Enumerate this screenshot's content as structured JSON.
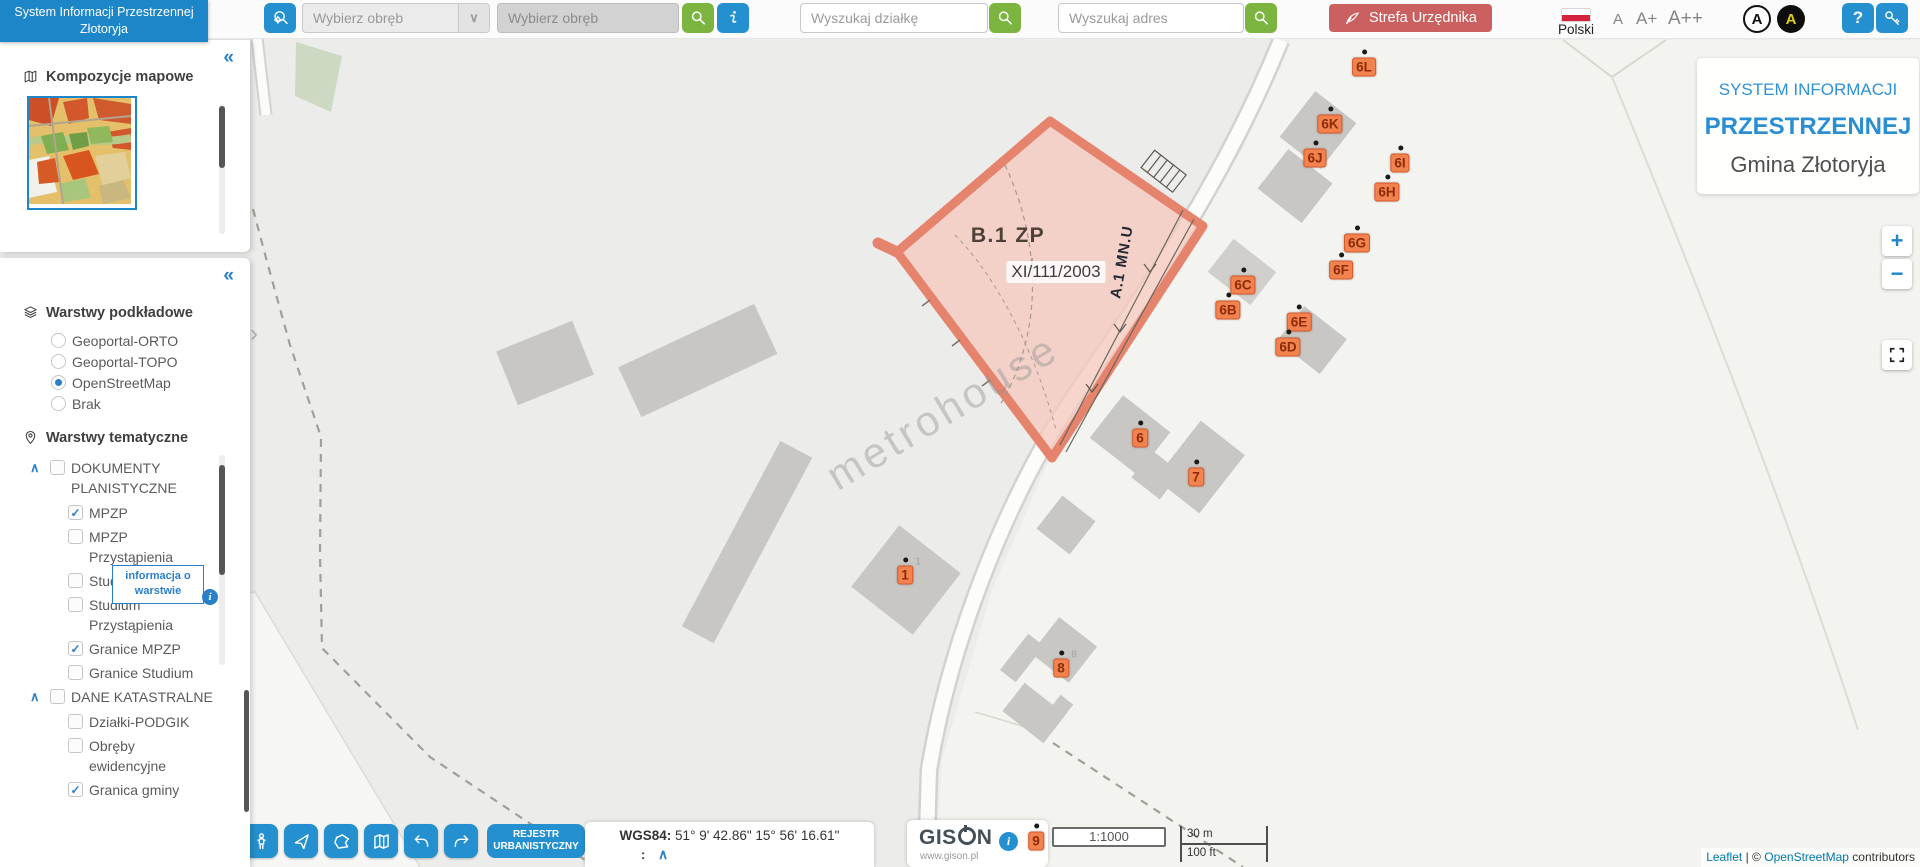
{
  "app": {
    "header_title": "System Informacji Przestrzennej Złotoryja",
    "language_label": "Polski",
    "font_size_buttons": [
      "A",
      "A+",
      "A++"
    ],
    "contrast_light_label": "A",
    "contrast_dark_label": "A",
    "help_label": "?"
  },
  "icons": {
    "collapse": "«",
    "expand": "›",
    "chevron_up": "∧",
    "chevron_down": "∨",
    "check": "✓",
    "info": "i"
  },
  "toolbar": {
    "obreb_select_value": "Wybierz obręb",
    "obreb_input_placeholder": "Wybierz obręb",
    "dzialka_placeholder": "Wyszukaj działkę",
    "adres_placeholder": "Wyszukaj adres",
    "strefa_label": "Strefa Urzędnika"
  },
  "sidebar": {
    "kompozycje_title": "Kompozycje mapowe",
    "podkladowe_title": "Warstwy podkładowe",
    "base_layers": [
      {
        "label": "Geoportal-ORTO",
        "selected": false
      },
      {
        "label": "Geoportal-TOPO",
        "selected": false
      },
      {
        "label": "OpenStreetMap",
        "selected": true
      },
      {
        "label": "Brak",
        "selected": false
      }
    ],
    "tematyczne_title": "Warstwy tematyczne",
    "layer_tree": [
      {
        "label": "DOKUMENTY PLANISTYCZNE",
        "checked": false,
        "children": [
          {
            "label": "MPZP",
            "checked": true
          },
          {
            "label": "MPZP Przystąpienia",
            "checked": false
          },
          {
            "label": "Studium",
            "checked": false
          },
          {
            "label": "Studium Przystąpienia",
            "checked": false
          },
          {
            "label": "Granice MPZP",
            "checked": true
          },
          {
            "label": "Granice Studium",
            "checked": false
          }
        ]
      },
      {
        "label": "DANE KATASTRALNE",
        "checked": false,
        "children": [
          {
            "label": "Działki-PODGIK",
            "checked": false
          },
          {
            "label": "Obręby ewidencyjne",
            "checked": false
          },
          {
            "label": "Granica gminy",
            "checked": true
          }
        ]
      }
    ],
    "layer_tooltip": "informacja o warstwie"
  },
  "map": {
    "title_card": {
      "line1": "SYSTEM INFORMACJI",
      "line2": "PRZESTRZENNEJ",
      "line3": "Gmina Złotoryja"
    },
    "zone_label": "B.1 ZP",
    "zone_doc": "XI/111/2003",
    "zone_edge_label": "A.1 MN.U",
    "watermark": "metrohouse",
    "zoom_in": "+",
    "zoom_out": "−",
    "markers": [
      {
        "label": "6L",
        "x": 1364,
        "y": 67
      },
      {
        "label": "6K",
        "x": 1330,
        "y": 124
      },
      {
        "label": "6J",
        "x": 1315,
        "y": 158
      },
      {
        "label": "6I",
        "x": 1400,
        "y": 163
      },
      {
        "label": "6H",
        "x": 1387,
        "y": 192
      },
      {
        "label": "6G",
        "x": 1357,
        "y": 243
      },
      {
        "label": "6F",
        "x": 1341,
        "y": 270
      },
      {
        "label": "6C",
        "x": 1243,
        "y": 285
      },
      {
        "label": "6B",
        "x": 1228,
        "y": 310
      },
      {
        "label": "6E",
        "x": 1299,
        "y": 322
      },
      {
        "label": "6D",
        "x": 1288,
        "y": 347
      },
      {
        "label": "6",
        "x": 1140,
        "y": 438
      },
      {
        "label": "7",
        "x": 1196,
        "y": 477
      },
      {
        "label": "1",
        "x": 905,
        "y": 575,
        "ghost": "1"
      },
      {
        "label": "8",
        "x": 1061,
        "y": 668,
        "ghost": "8"
      },
      {
        "label": "9",
        "x": 1036,
        "y": 841
      }
    ],
    "attribution": {
      "leaflet": "Leaflet",
      "separator": "|",
      "copyright": "©",
      "osm": "OpenStreetMap",
      "suffix": "contributors"
    }
  },
  "bottom": {
    "tools": [
      "select-cursor",
      "printer",
      "measure",
      "link",
      "map-pin",
      "expand",
      "street-view",
      "navigate",
      "draw-polygon",
      "map-layers",
      "undo",
      "redo"
    ],
    "rejestr_label": "REJESTR URBANISTYCZNY",
    "coords_label": "WGS84:",
    "coords_value": "51° 9' 42.86\" 15° 56' 16.61\"",
    "coords_colon": ":",
    "gison_name": "GISON",
    "gison_url": "www.gison.pl",
    "scale_ratio": "1:1000",
    "scale_metric": "30 m",
    "scale_imperial": "100 ft"
  },
  "colors": {
    "accent_blue": "#2590cf",
    "header_blue": "#1d86c8",
    "button_green": "#7bb43e",
    "button_red": "#ca6160",
    "marker_orange": "#f2824e",
    "zone_pink": "#f5c9bf",
    "link_blue": "#0078a8"
  }
}
